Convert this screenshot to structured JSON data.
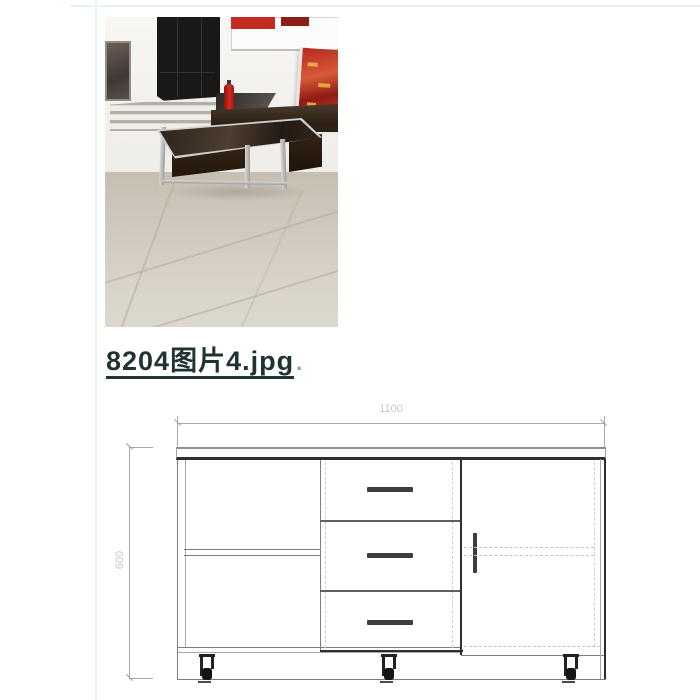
{
  "page": {
    "background": "#ffffff",
    "grid_line_color": "#e6f2f3"
  },
  "attachment": {
    "filename": "8204图片4.jpg",
    "suffix_period": ".",
    "link_color": "#1f3333"
  },
  "drawing": {
    "width_dimension": "1100",
    "height_dimension": "600",
    "dim_text_color": "#c6c6c6",
    "outline_color": "#7d7d7d",
    "dark_line_color": "#2e2e2e",
    "dashed_line_color": "#cfcfcf",
    "handle_color": "#3d3d3d"
  },
  "photo": {
    "colors": {
      "wall": "#f4f2ef",
      "floor": "#cdc5b8",
      "doorway": "#1a1816",
      "banner_red": "#c32a20",
      "poster_red": "#b8291f",
      "extinguisher_red": "#d42a20",
      "table_wood": "#3a2a1c",
      "metal_frame": "#c8c8c6",
      "bench_wood": "#3a2c1e"
    }
  }
}
